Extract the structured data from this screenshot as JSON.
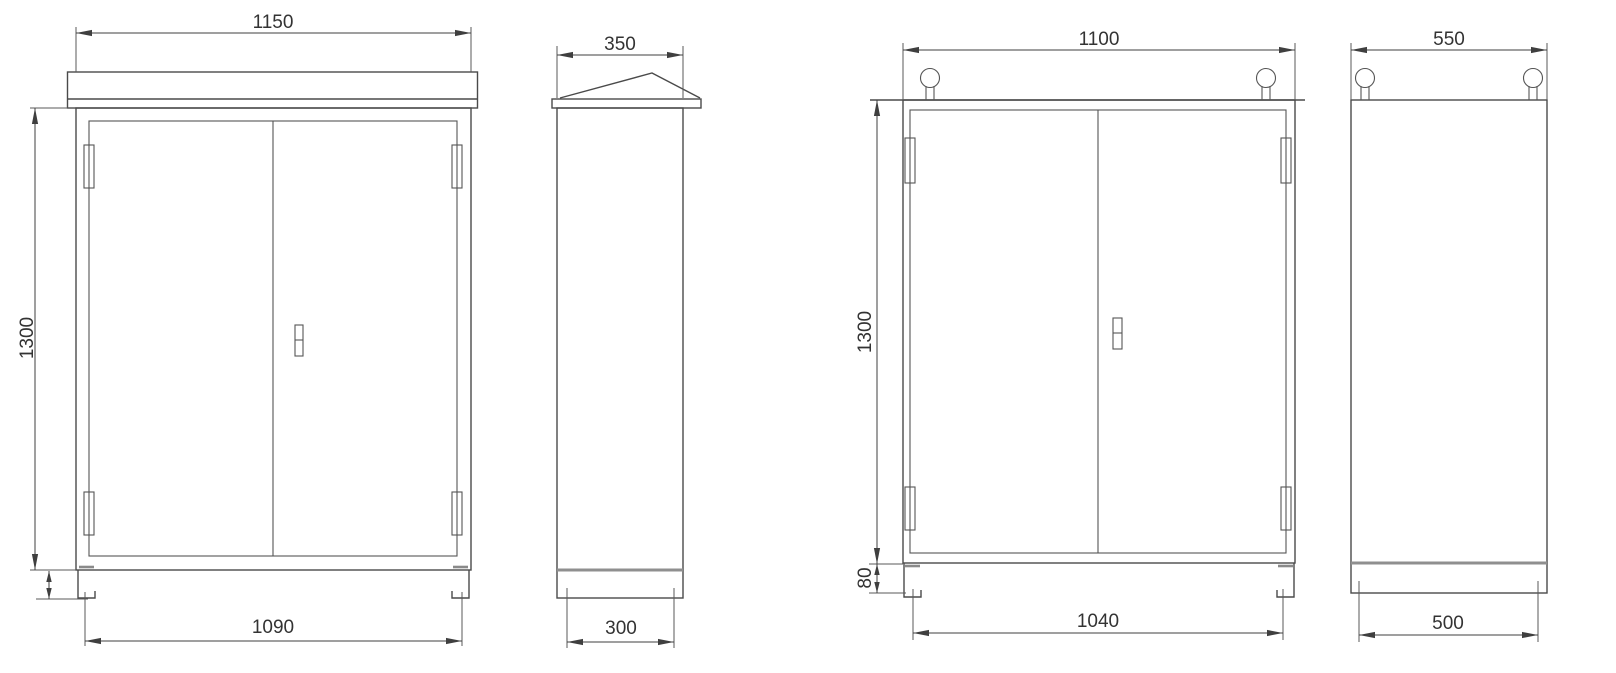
{
  "page": {
    "background_color": "#ffffff",
    "line_color": "#4a4a4a",
    "text_color": "#333333",
    "type": "engineering dimension drawing of two outdoor electrical cabinets (front and side views)"
  },
  "views": [
    {
      "id": "cabinet-a-front",
      "features": [
        "rain canopy",
        "double doors",
        "four hinges",
        "door handle",
        "two channel feet"
      ],
      "dimensions": {
        "top_width": "1150",
        "height": "1300",
        "base_width": "1090"
      }
    },
    {
      "id": "cabinet-a-side",
      "features": [
        "sloped rain roof",
        "base plinth"
      ],
      "dimensions": {
        "top_depth": "350",
        "base_depth": "300"
      }
    },
    {
      "id": "cabinet-b-front",
      "features": [
        "two lifting eyes",
        "double doors",
        "four hinges",
        "door handle",
        "two channel feet"
      ],
      "dimensions": {
        "top_width": "1100",
        "height": "1300",
        "foot_height": "80",
        "base_width": "1040"
      }
    },
    {
      "id": "cabinet-b-side",
      "features": [
        "two lifting eyes",
        "base plinth"
      ],
      "dimensions": {
        "top_depth": "550",
        "base_depth": "500"
      }
    }
  ]
}
